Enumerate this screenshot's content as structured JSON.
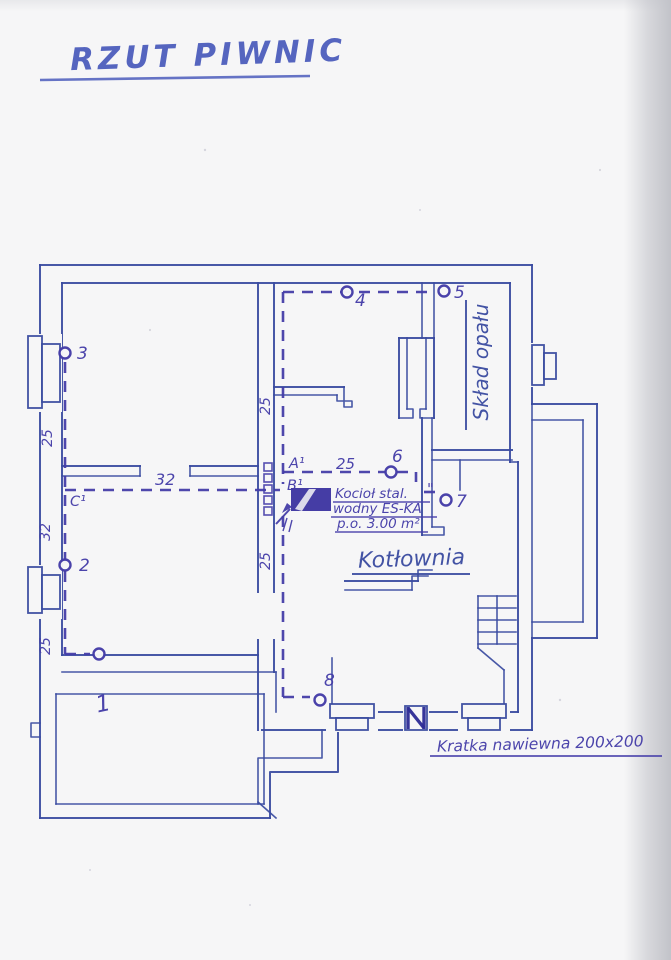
{
  "title": "RZUT PIWNIC",
  "rooms": {
    "boiler_room": "Kotłownia",
    "fuel_storage": "Skład opału"
  },
  "boiler_note": {
    "line1": "Kocioł stal.",
    "line2": "wodny ES-KA",
    "line3": "p.o. 3.00 m²"
  },
  "grille_note": "Kratka nawiewna 200x200",
  "points": {
    "p1": "1",
    "p2": "2",
    "p3": "3",
    "p4": "4",
    "p5": "5",
    "p6": "6",
    "p7": "7",
    "p8": "8"
  },
  "sections": {
    "a": "A¹",
    "b": "B¹",
    "c": "C¹",
    "ditto": "\""
  },
  "dimensions": {
    "left_upper": "25",
    "left_mid": "32",
    "left_lower": "25",
    "center_upper": "25",
    "center_lower": "25",
    "a_line": "25",
    "c_line": "32"
  },
  "colors": {
    "ink_blue": "#3a4ba0",
    "ink_violet": "#453da8",
    "grille_ink": "#2e2d96",
    "boiler_fill": "#3b33a0",
    "title_blue": "#5565bf",
    "paper": "#f6f6f7"
  }
}
